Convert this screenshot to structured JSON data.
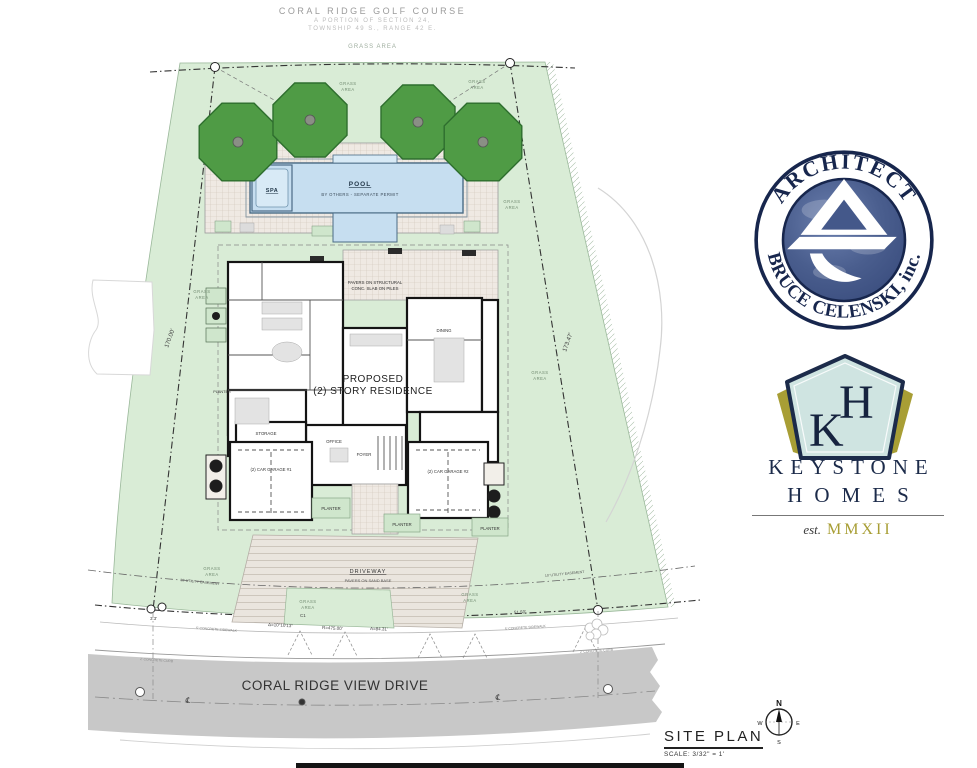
{
  "header": {
    "title": "CORAL RIDGE GOLF COURSE",
    "sub1": "A PORTION OF SECTION 24,",
    "sub2": "TOWNSHIP 49 S., RANGE 42 E.",
    "grass": "GRASS AREA"
  },
  "labels": {
    "grass_word1": "GRASS",
    "grass_word2": "AREA",
    "planter": "PLANTER"
  },
  "pool": {
    "label": "POOL",
    "note": "BY OTHERS - SEPARATE PERMIT",
    "spa": "SPA"
  },
  "house": {
    "line1": "PROPOSED",
    "line2": "(2) STORY RESIDENCE",
    "pavers1": "PAVERS ON STRUCTURAL",
    "pavers2": "CONC. SLAB ON PILES",
    "dining": "DINING",
    "storage": "STORAGE",
    "office": "OFFICE",
    "foyer": "FOYER",
    "garage1": "(2) CAR GARAGE #1",
    "garage2": "(2) CAR GARAGE #2"
  },
  "driveway": {
    "label": "DRIVEWAY",
    "note": "PAVERS ON SAND BASE"
  },
  "dims": {
    "left": "170.00'",
    "right": "173.47'",
    "front": "51.50'",
    "corner": "3.3'",
    "curve": "C1",
    "delta": "Δ=10°10'13\"",
    "radius": "R=475.00'",
    "arc": "A=84.31'"
  },
  "notes": {
    "easement": "10' UTILITY EASEMENT",
    "sidewalk": "5' CONCRETE SIDEWALK",
    "curb": "2' CONCRETE CURB"
  },
  "road": {
    "name": "CORAL RIDGE VIEW DRIVE",
    "cl": "℄"
  },
  "architect": {
    "arc_top": "ARCHITECT",
    "arc_bottom": "BRUCE CELENSKI, inc."
  },
  "keystone": {
    "k": "K",
    "h": "H",
    "name1": "KEYSTONE",
    "name2": "HOMES",
    "est": "est.",
    "year": "MMXII"
  },
  "titleblock": {
    "title": "SITE PLAN",
    "scale": "SCALE: 3/32\" = 1'"
  },
  "compass": {
    "n": "N",
    "s": "S",
    "e": "E",
    "w": "W"
  },
  "colors": {
    "grass": "#d9ecd6",
    "tree": "#4f9b45",
    "pool": "#c6def0",
    "road": "#c8c8c8",
    "navy": "#1c2b4a",
    "gold": "#a89e35",
    "paver": "#efe9e3"
  }
}
